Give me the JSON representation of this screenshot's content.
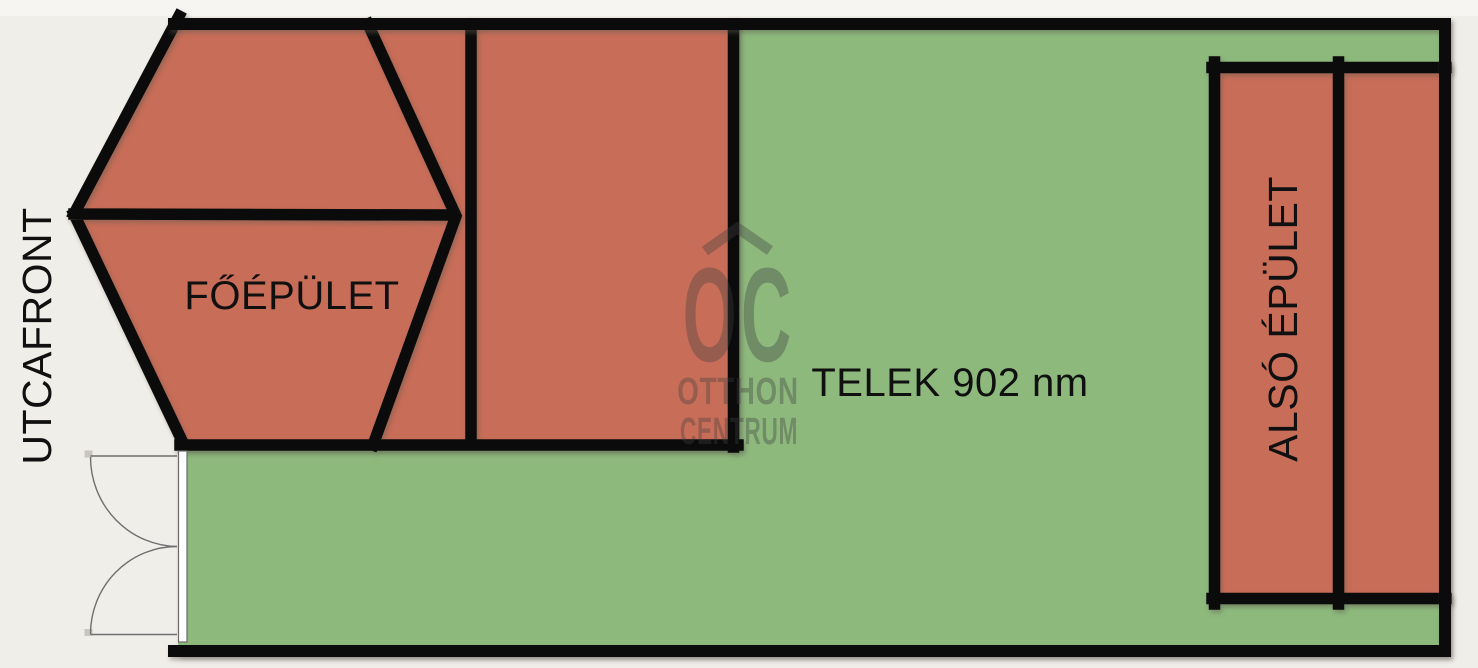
{
  "plan": {
    "street_front_label": "UTCAFRONT",
    "main_building_label": "FŐÉPÜLET",
    "plot_label": "TELEK 902 nm",
    "plot_area_sqm": 902,
    "lower_building_label": "ALSÓ ÉPÜLET"
  },
  "watermark": {
    "logo_text": "OC",
    "brand_line1": "OTTHON",
    "brand_line2": "CENTRUM"
  },
  "colors": {
    "background": "#f0eee9",
    "top_strip": "#f6f5f2",
    "plot_green": "#8db97d",
    "building_red": "#c86d58",
    "outline_black": "#0b0b0b",
    "watermark_gray": "#3f3f3f",
    "door_white": "#ffffff",
    "door_line_gray": "#6f6f6f"
  }
}
